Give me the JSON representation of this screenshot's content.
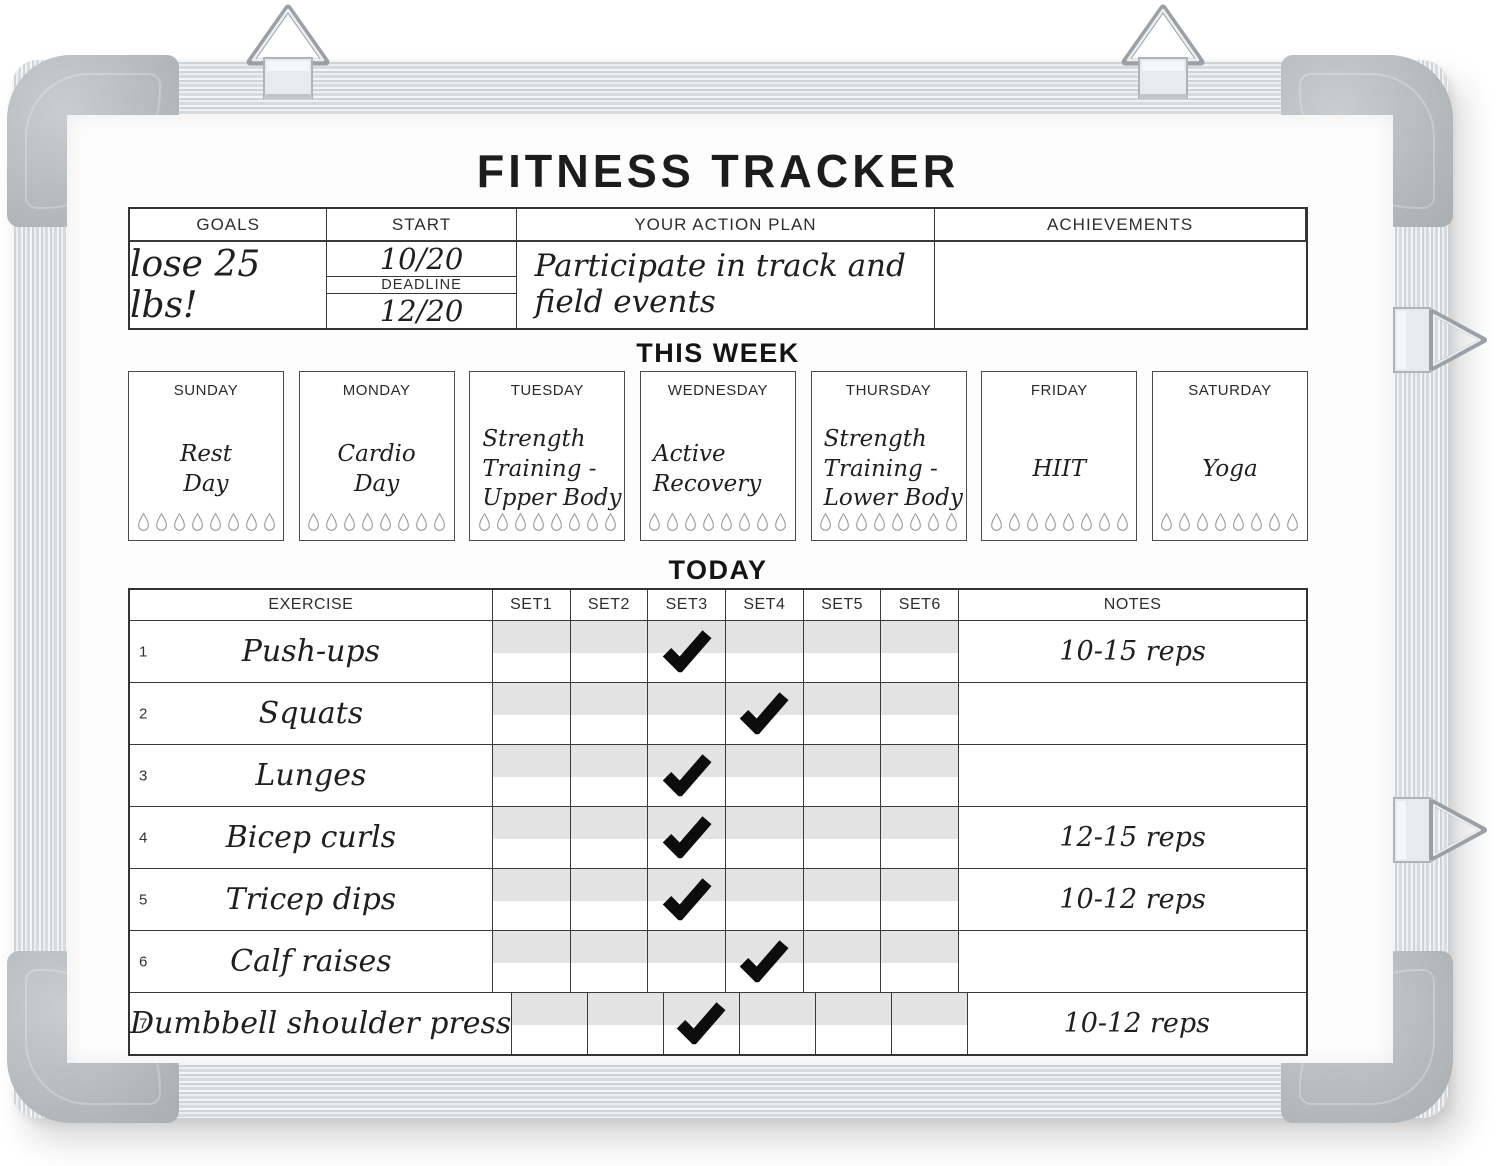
{
  "board": {
    "title": "FITNESS TRACKER"
  },
  "goals_table": {
    "headers": {
      "goals": "GOALS",
      "start": "START",
      "action_plan": "YOUR ACTION PLAN",
      "achievements": "ACHIEVEMENTS"
    },
    "goal_value": "lose 25 lbs!",
    "start_date": "10/20",
    "deadline_label": "DEADLINE",
    "deadline_date": "12/20",
    "action_plan_value": "Participate in track and\nfield events",
    "achievements_value": ""
  },
  "week": {
    "heading": "THIS WEEK",
    "droplets_per_day": 8,
    "days": [
      {
        "label": "SUNDAY",
        "activity": "Rest\nDay"
      },
      {
        "label": "MONDAY",
        "activity": "Cardio\nDay"
      },
      {
        "label": "TUESDAY",
        "activity": "Strength\nTraining -\nUpper Body"
      },
      {
        "label": "WEDNESDAY",
        "activity": "Active\nRecovery"
      },
      {
        "label": "THURSDAY",
        "activity": "Strength\nTraining -\nLower Body"
      },
      {
        "label": "FRIDAY",
        "activity": "HIIT"
      },
      {
        "label": "SATURDAY",
        "activity": "Yoga"
      }
    ]
  },
  "today": {
    "heading": "TODAY",
    "headers": {
      "exercise": "EXERCISE",
      "sets": [
        "SET1",
        "SET2",
        "SET3",
        "SET4",
        "SET5",
        "SET6"
      ],
      "notes": "NOTES"
    },
    "rows": [
      {
        "num": "1",
        "exercise": "Push-ups",
        "checked_set": 3,
        "notes": "10-15 reps"
      },
      {
        "num": "2",
        "exercise": "Squats",
        "checked_set": 4,
        "notes": ""
      },
      {
        "num": "3",
        "exercise": "Lunges",
        "checked_set": 3,
        "notes": ""
      },
      {
        "num": "4",
        "exercise": "Bicep curls",
        "checked_set": 3,
        "notes": "12-15 reps"
      },
      {
        "num": "5",
        "exercise": "Tricep dips",
        "checked_set": 3,
        "notes": "10-12 reps"
      },
      {
        "num": "6",
        "exercise": "Calf raises",
        "checked_set": 4,
        "notes": ""
      },
      {
        "num": "7",
        "exercise": "Dumbbell shoulder press",
        "checked_set": 3,
        "notes": "10-12 reps"
      }
    ]
  },
  "colors": {
    "stripe_gray": "#e3e3e3",
    "table_border": "#3a3a3a",
    "frame_corner_gray": "#b4b9bd",
    "ink_black": "#1c1c1c",
    "droplet_gray": "#9c9c9c"
  }
}
